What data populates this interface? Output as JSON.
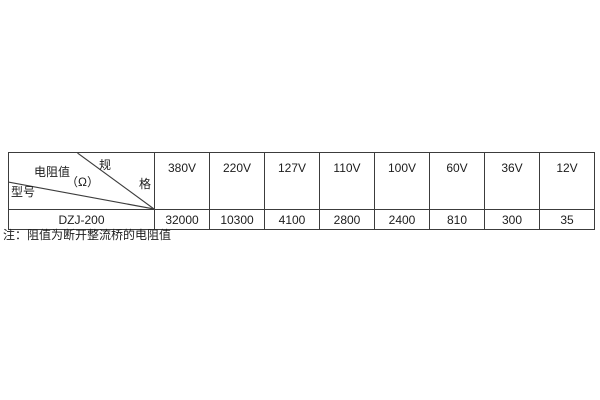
{
  "table": {
    "corner": {
      "spec_label_part1": "规",
      "spec_label_part2": "格",
      "resistance_label": "电阻值",
      "resistance_unit": "（Ω）",
      "model_label": "型号"
    },
    "columns": [
      "380V",
      "220V",
      "127V",
      "110V",
      "100V",
      "60V",
      "36V",
      "12V"
    ],
    "row": {
      "model": "DZJ-200",
      "values": [
        "32000",
        "10300",
        "4100",
        "2800",
        "2400",
        "810",
        "300",
        "35"
      ]
    },
    "border_color": "#3c3c3c",
    "text_color": "#1c1c1c",
    "background_color": "#ffffff"
  },
  "note": "注：阻值为断开整流桥的电阻值"
}
